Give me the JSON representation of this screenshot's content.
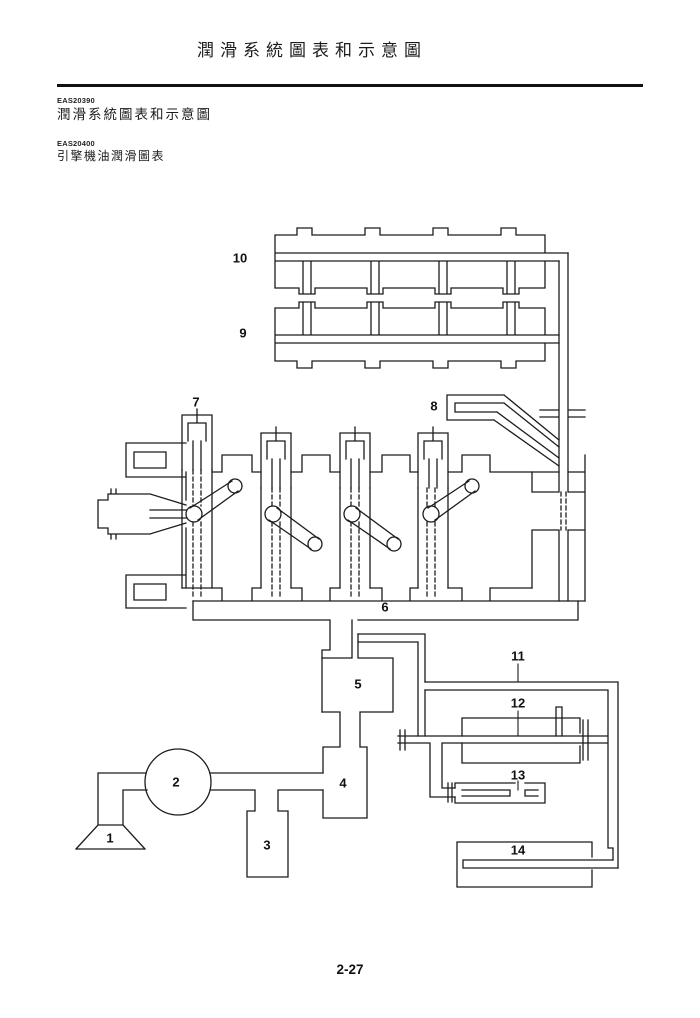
{
  "page": {
    "running_title": "潤滑系統圖表和示意圖",
    "page_number": "2-27"
  },
  "sections": [
    {
      "code": "EAS20390",
      "title": "潤滑系統圖表和示意圖"
    },
    {
      "code": "EAS20400",
      "title": "引擎機油潤滑圖表"
    }
  ],
  "diagram": {
    "name": "engine-oil-lubrication-chart",
    "ink_color": "#1c1c1c",
    "paper_color": "#ffffff",
    "labels": [
      {
        "n": "1",
        "x": 110,
        "y": 838
      },
      {
        "n": "2",
        "x": 176,
        "y": 782
      },
      {
        "n": "3",
        "x": 267,
        "y": 845
      },
      {
        "n": "4",
        "x": 343,
        "y": 783
      },
      {
        "n": "5",
        "x": 358,
        "y": 684
      },
      {
        "n": "6",
        "x": 385,
        "y": 607
      },
      {
        "n": "7",
        "x": 196,
        "y": 402
      },
      {
        "n": "8",
        "x": 434,
        "y": 406
      },
      {
        "n": "9",
        "x": 243,
        "y": 333
      },
      {
        "n": "10",
        "x": 240,
        "y": 258
      },
      {
        "n": "11",
        "x": 518,
        "y": 656
      },
      {
        "n": "12",
        "x": 518,
        "y": 703
      },
      {
        "n": "13",
        "x": 518,
        "y": 775
      },
      {
        "n": "14",
        "x": 518,
        "y": 850
      }
    ]
  }
}
